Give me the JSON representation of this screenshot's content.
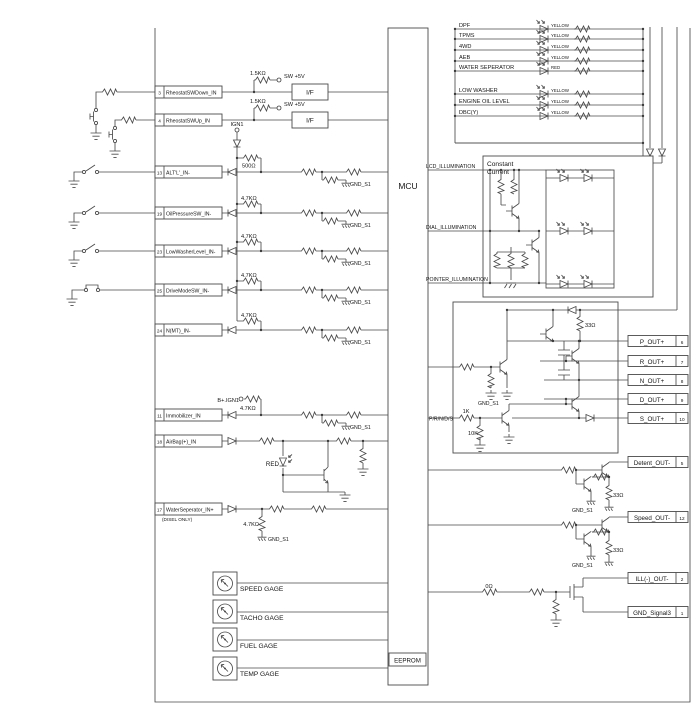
{
  "labels": {
    "mcu": "MCU",
    "eeprom": "EEPROM",
    "if": "I/F",
    "gnd_s1": "GND_S1",
    "ign1": "IGN1",
    "sw_5v": "SW +5V",
    "b_ign1": "B+.IGN1",
    "red": "RED",
    "prnds": "P/R/N/D/S",
    "constant_current_1": "Constant",
    "constant_current_2": "Current",
    "disel_only": "(DISEL ONLY)"
  },
  "resistors": {
    "r1k5": "1.5KΩ",
    "r500": "500Ω",
    "r4k7": "4.7KΩ",
    "r33": "33Ω",
    "r1k": "1K",
    "r10k": "10K",
    "r0": "0Ω"
  },
  "left_pins": [
    {
      "num": "3",
      "label": "RheostatSWDown_IN"
    },
    {
      "num": "4",
      "label": "RheostatSWUp_IN"
    },
    {
      "num": "13",
      "label": "ALT'L'_IN-"
    },
    {
      "num": "19",
      "label": "OilPressureSW_IN-"
    },
    {
      "num": "23",
      "label": "LowWasherLevel_IN-"
    },
    {
      "num": "25",
      "label": "DriveModeSW_IN-"
    },
    {
      "num": "24",
      "label": "N(MT)_IN-"
    },
    {
      "num": "11",
      "label": "Immobilizer_IN"
    },
    {
      "num": "18",
      "label": "AirBag(+)_IN"
    },
    {
      "num": "17",
      "label": "WaterSeperator_IN+"
    }
  ],
  "warning_lamps": [
    {
      "label": "DPF",
      "wire": "YELLOW"
    },
    {
      "label": "TPMS",
      "wire": "YELLOW"
    },
    {
      "label": "4WD",
      "wire": "YELLOW"
    },
    {
      "label": "AEB",
      "wire": "YELLOW"
    },
    {
      "label": "WATER SEPERATOR",
      "wire": "RED"
    },
    {
      "label": "LOW WASHER",
      "wire": "YELLOW"
    },
    {
      "label": "ENGINE OIL LEVEL",
      "wire": "YELLOW"
    },
    {
      "label": "DBC(Y)",
      "wire": "YELLOW"
    }
  ],
  "illumination_outputs": [
    "LCD_ILLUMINATION",
    "DIAL_ILLUMINATION",
    "POINTER_ILLUMINATION"
  ],
  "right_pins": [
    {
      "label": "P_OUT+",
      "num": "6"
    },
    {
      "label": "R_OUT+",
      "num": "7"
    },
    {
      "label": "N_OUT+",
      "num": "8"
    },
    {
      "label": "D_OUT+",
      "num": "9"
    },
    {
      "label": "S_OUT+",
      "num": "10"
    },
    {
      "label": "Detent_OUT-",
      "num": "5"
    },
    {
      "label": "Speed_OUT-",
      "num": "12"
    },
    {
      "label": "ILL(-)_OUT-",
      "num": "2"
    },
    {
      "label": "GND_Signal3",
      "num": "1"
    }
  ],
  "gauges": [
    "SPEED GAGE",
    "TACHO GAGE",
    "FUEL GAGE",
    "TEMP GAGE"
  ]
}
